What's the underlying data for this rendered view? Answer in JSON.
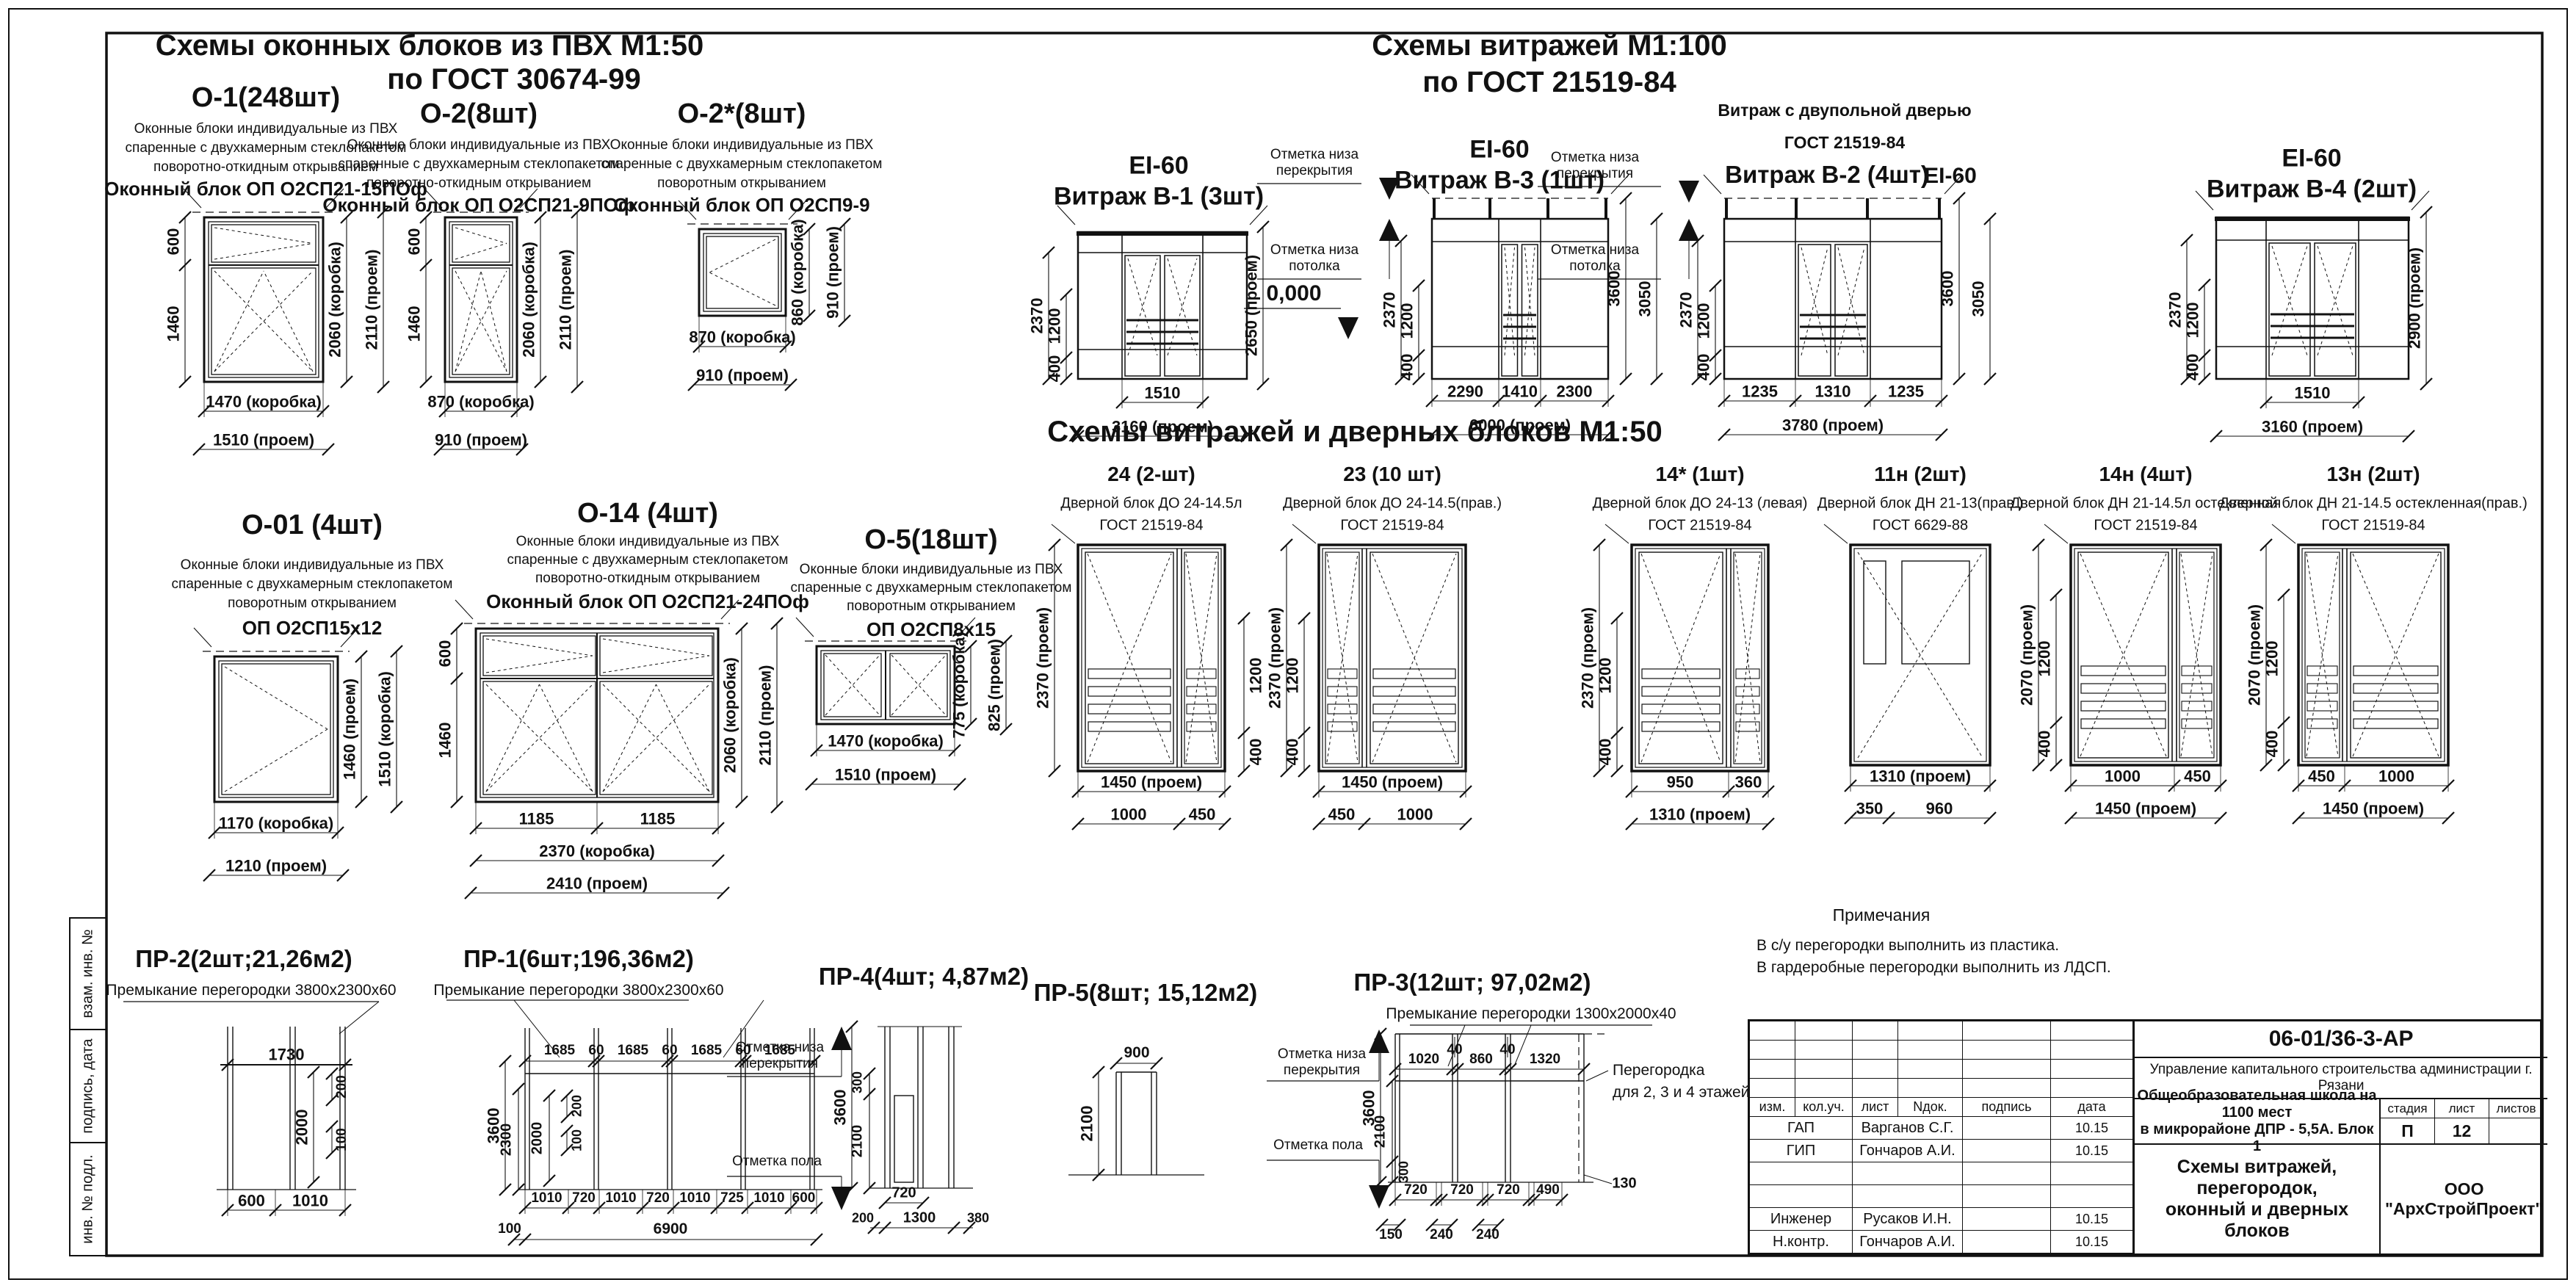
{
  "sheet": {
    "headers": {
      "windows": [
        "Схемы оконных  блоков из ПВХ М1:50",
        "по ГОСТ 30674-99"
      ],
      "vitrages": [
        "Схемы витражей М1:100",
        "по ГОСТ 21519-84"
      ],
      "vitrages_doors": "Схемы витражей и дверных блоков М1:50"
    },
    "frame_labels": [
      "взам. инв. №",
      "подпись, дата",
      "инв. № подл."
    ]
  },
  "panels": {
    "o1": {
      "title": "О-1(248шт)",
      "desc": [
        "Оконные блоки индивидуальные из ПВХ",
        "спаренные с двухкамерным стеклопакетом",
        "поворотно-откидным открыванием"
      ],
      "product": "Оконный блок ОП О2СП21-15ПОф",
      "dl": [
        "600",
        "1460"
      ],
      "dr": [
        "2060 (коробка)",
        "2110 (проем)"
      ],
      "db": [
        "1470 (коробка)",
        "1510 (проем)"
      ]
    },
    "o2": {
      "title": "О-2(8шт)",
      "desc": [
        "Оконные блоки индивидуальные из ПВХ",
        "спаренные с двухкамерным стеклопакетом",
        "поворотно-откидным открыванием"
      ],
      "product": "Оконный блок ОП О2СП21-9ПОф",
      "dl": [
        "600",
        "1460"
      ],
      "dr": [
        "2060 (коробка)",
        "2110 (проем)"
      ],
      "db": [
        "870 (коробка)",
        "910 (проем)"
      ]
    },
    "o2s": {
      "title": "О-2*(8шт)",
      "desc": [
        "Оконные блоки индивидуальные из ПВХ",
        "спаренные с двухкамерным стеклопакетом",
        "поворотным открыванием"
      ],
      "product": "Оконный блок ОП О2СП9-9",
      "dr": [
        "860 (коробка)",
        "910 (проем)"
      ],
      "db": [
        "870 (коробка)",
        "910 (проем)"
      ]
    },
    "v1": {
      "ei": "EI-60",
      "title": "Витраж В-1 (3шт)",
      "dl": [
        "2370",
        "1200",
        "400"
      ],
      "dr": [
        "2650 (проем)"
      ],
      "db1": "1510",
      "db2": "3160 (проем)"
    },
    "v3": {
      "ei": "EI-60",
      "title": "Витраж В-3 (1шт)",
      "marks": [
        "Отметка низа перекрытия",
        "Отметка низа потолка"
      ],
      "level": "0,000",
      "dl": [
        "2370",
        "1200",
        "400"
      ],
      "dr": [
        "3600",
        "3050"
      ],
      "db1": [
        "2290",
        "1410",
        "2300"
      ],
      "db2": "6000   (проем)"
    },
    "v2": {
      "top": "Витраж с двупольной дверью",
      "gost": "ГОСТ 21519-84",
      "title": "Витраж В-2 (4шт)",
      "ei": "EI-60",
      "marks": [
        "Отметка низа перекрытия",
        "Отметка низа потолка"
      ],
      "dl": [
        "2370",
        "1200",
        "400"
      ],
      "dr": [
        "3600",
        "3050"
      ],
      "db1": [
        "1235",
        "1310",
        "1235"
      ],
      "db2": "3780 (проем)"
    },
    "v4": {
      "ei": "EI-60",
      "title": "Витраж В-4 (2шт)",
      "dl": [
        "2370",
        "1200",
        "400"
      ],
      "dr": [
        "2900 (проем)"
      ],
      "db1": "1510",
      "db2": "3160 (проем)"
    },
    "d24": {
      "title": "24 (2-шт)",
      "name": "Дверной блок ДО 24-14.5л",
      "gost": "ГОСТ 21519-84",
      "dl": [
        "2370  (проем)",
        "1200",
        "400"
      ],
      "db1": "1450 (проем)",
      "db2": [
        "1000",
        "450"
      ]
    },
    "d23": {
      "title": "23 (10 шт)",
      "name": "Дверной блок ДО 24-14.5(прав.)",
      "gost": "ГОСТ 21519-84",
      "dl": [
        "2370  (проем)",
        "1200",
        "400"
      ],
      "db1": "1450 (проем)",
      "db2": [
        "450",
        "1000"
      ]
    },
    "d14s": {
      "title": "14* (1шт)",
      "name": "Дверной блок ДО 24-13 (левая)",
      "gost": "ГОСТ 21519-84",
      "dl": [
        "2370  (проем)",
        "1200",
        "400"
      ],
      "db1": [
        "950",
        "360"
      ],
      "db2": "1310    (проем)"
    },
    "d11n": {
      "title": "11н (2шт)",
      "name": "Дверной блок ДН 21-13(прав.)",
      "gost": "ГОСТ 6629-88",
      "db1": "1310 (проем)",
      "db2": [
        "350",
        "960"
      ]
    },
    "d14n": {
      "title": "14н (4шт)",
      "name": "Дверной блок ДН 21-14.5л остекленная",
      "gost": "ГОСТ 21519-84",
      "dl": [
        "2070  (проем)",
        "1200",
        "400"
      ],
      "db1": [
        "1000",
        "450"
      ],
      "db2": "1450   (проем)"
    },
    "d13n": {
      "title": "13н (2шт)",
      "name": "Дверной блок ДН 21-14.5 остекленная(прав.)",
      "gost": "ГОСТ 21519-84",
      "dl": [
        "2070  (проем)",
        "1200",
        "400"
      ],
      "db1": [
        "450",
        "1000"
      ],
      "db2": "1450   (проем)"
    },
    "o01": {
      "title": "О-01 (4шт)",
      "desc": [
        "Оконные блоки индивидуальные из ПВХ",
        "спаренные с двухкамерным стеклопакетом",
        "поворотным открыванием"
      ],
      "product": "ОП О2СП15х12",
      "dr": [
        "1460 (проем)",
        "1510 (коробка)"
      ],
      "db": [
        "1170 (коробка)",
        "1210 (проем)"
      ]
    },
    "o14": {
      "title": "О-14 (4шт)",
      "desc": [
        "Оконные блоки индивидуальные из ПВХ",
        "спаренные с двухкамерным стеклопакетом",
        "поворотно-откидным открыванием"
      ],
      "product": "Оконный блок ОП О2СП21-24ПОф",
      "dl": [
        "600",
        "1460"
      ],
      "dr": [
        "2060 (коробка)",
        "2110 (проем)"
      ],
      "db1": [
        "1185",
        "1185"
      ],
      "db2": "2370 (коробка)",
      "db3": "2410 (проем)"
    },
    "o5": {
      "title": "О-5(18шт)",
      "desc": [
        "Оконные блоки индивидуальные из ПВХ",
        "спаренные с двухкамерным стеклопакетом",
        "поворотным открыванием"
      ],
      "product": "ОП О2СП8х15",
      "dr": [
        "775 (коробка)",
        "825 (проем)"
      ],
      "db": [
        "1470 (коробка)",
        "1510 (проем)"
      ]
    },
    "pr2": {
      "title": "ПР-2(2шт;21,26м2)",
      "sub": "Премыкание перегородки 3800х2300х60",
      "dt": "1730",
      "di": [
        "2000",
        "200",
        "100"
      ],
      "db": [
        "600",
        "1010"
      ]
    },
    "pr1": {
      "title": "ПР-1(6шт;196,36м2)",
      "sub": "Премыкание перегородки 3800х2300х60",
      "dt": [
        "1685",
        "60",
        "1685",
        "60",
        "1685",
        "60",
        "1685"
      ],
      "dl": [
        "3600",
        "2300",
        "2000",
        "200",
        "100"
      ],
      "db1": [
        "1010",
        "720",
        "1010",
        "720",
        "1010",
        "725",
        "1010",
        "600"
      ],
      "db2": [
        "100",
        "6900"
      ]
    },
    "pr4": {
      "title": "ПР-4(4шт; 4,87м2)",
      "marks": [
        "Отметка низа перекрытия",
        "Отметка пола"
      ],
      "dl": [
        "3600",
        "2100",
        "300"
      ],
      "db": [
        "200",
        "720",
        "1300",
        "380"
      ]
    },
    "pr5": {
      "title": "ПР-5(8шт; 15,12м2)",
      "dt": "900",
      "dl": [
        "2100"
      ]
    },
    "pr3": {
      "title": "ПР-3(12шт; 97,02м2)",
      "sub": "Премыкание перегородки 1300х2000х40",
      "marks": [
        "Отметка низа перекрытия",
        "Отметка пола"
      ],
      "note": [
        "Перегородка",
        "для 2, 3 и 4 этажей"
      ],
      "dt": [
        "40",
        "40"
      ],
      "dm": [
        "1020",
        "860",
        "1320"
      ],
      "dl": [
        "3600",
        "2100",
        "300"
      ],
      "db1": [
        "720",
        "720",
        "720",
        "490"
      ],
      "db_side": "130",
      "db2": [
        "150",
        "240",
        "240"
      ]
    }
  },
  "notes": {
    "title": "Примечания",
    "lines": [
      "В с/у перегородки выполнить из пластика.",
      "В гардеробные перегородки выполнить из ЛДСП."
    ]
  },
  "stamp": {
    "doc": "06-01/36-3-АР",
    "org": "Управление капитального строительства администрации г. Рязани",
    "object1": "Общеобразовательная школа на 1100 мест",
    "object2": "в микрорайоне ДПР - 5,5А. Блок 1",
    "cols": [
      "изм.",
      "кол.уч.",
      "лист",
      "Nдок.",
      "подпись",
      "дата"
    ],
    "rows": [
      [
        "ГАП",
        "Варганов С.Г.",
        "10.15"
      ],
      [
        "ГИП",
        "Гончаров А.И.",
        "10.15"
      ],
      [
        "",
        "",
        ""
      ],
      [
        "",
        "",
        ""
      ],
      [
        "Инженер",
        "Русаков И.Н.",
        "10.15"
      ],
      [
        "Н.контр.",
        "Гончаров А.И.",
        "10.15"
      ]
    ],
    "stage_label": "стадия",
    "sheet_label": "лист",
    "sheets_label": "листов",
    "stage": "П",
    "sheet_no": "12",
    "sheet_name1": "Схемы витражей, перегородок,",
    "sheet_name2": "оконный и дверных блоков",
    "company": "ООО \"АрхСтройПроект\""
  }
}
